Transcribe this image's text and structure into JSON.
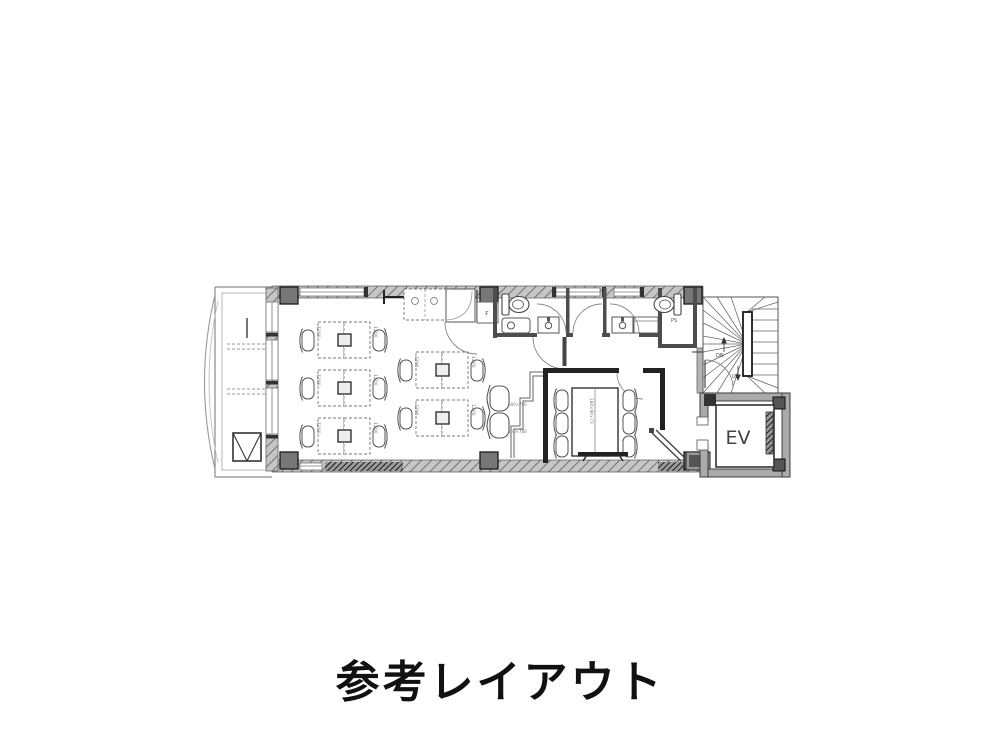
{
  "title": "参考レイアウト",
  "plan": {
    "labels": {
      "elevator": "EV",
      "stairs_down": "DN",
      "stairs_up": "UP",
      "pipe_shaft": "PS",
      "refrigerator": "F",
      "desk_size": "1200",
      "sofa_size": "600×780",
      "table_size": "180×90×73"
    },
    "colors": {
      "wall_fill": "#c2c2c2",
      "column_fill": "#777777",
      "line": "#444444"
    }
  }
}
